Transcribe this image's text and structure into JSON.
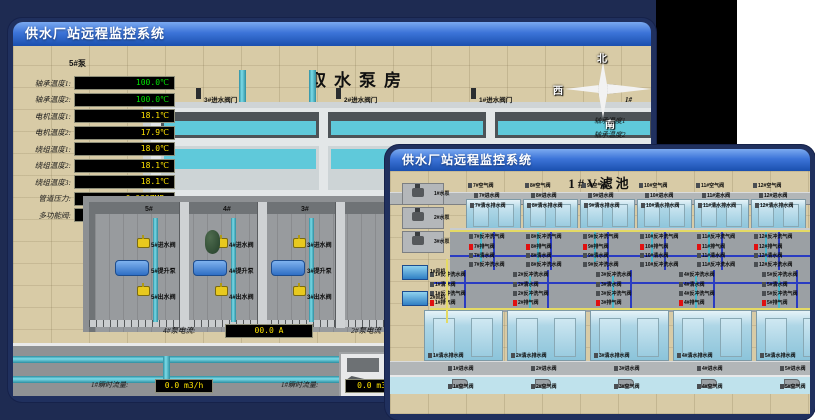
{
  "colors": {
    "backdrop": "#1e2b52",
    "black_panel": "#000000",
    "titlebar_blue": "#1a4fae",
    "value_green": "#00e400",
    "value_yellow": "#ffe400",
    "alarm_red": "#e01010",
    "pipe_cyan": "#5fc9da"
  },
  "back_window": {
    "title": "供水厂站远程监控系统",
    "scene_title": "取水泵房",
    "pump_panel": {
      "header": "5#泵",
      "rows": [
        {
          "label": "轴承温度1:",
          "value": "100.0℃",
          "color": "#00e400"
        },
        {
          "label": "轴承温度2:",
          "value": "100.0℃",
          "color": "#00e400"
        },
        {
          "label": "电机温度1:",
          "value": "18.1℃",
          "color": "#ffe400"
        },
        {
          "label": "电机温度2:",
          "value": "17.9℃",
          "color": "#ffe400"
        },
        {
          "label": "绕组温度1:",
          "value": "18.0℃",
          "color": "#ffe400"
        },
        {
          "label": "绕组温度2:",
          "value": "18.1℃",
          "color": "#ffe400"
        },
        {
          "label": "绕组温度3:",
          "value": "18.1℃",
          "color": "#ffe400"
        },
        {
          "label": "管道压力:",
          "value": "0.0007MPa",
          "color": "#ffe400"
        },
        {
          "label": "多功能阀:",
          "value": "0%",
          "color": "#ffe400"
        }
      ]
    },
    "inlet_valves": [
      "3#进水阀门",
      "2#进水阀门",
      "1#进水阀门"
    ],
    "compass": {
      "north": "北",
      "west": "西",
      "south": "南"
    },
    "right_partial_labels": [
      "1#",
      "轴承温度1",
      "轴承温度2"
    ],
    "pump_bays": [
      {
        "no": "5#",
        "inlet": "5#进水阀",
        "pump": "5#提升泵",
        "outlet": "5#出水阀"
      },
      {
        "no": "4#",
        "inlet": "4#进水阀",
        "pump": "4#提升泵",
        "outlet": "4#出水阀"
      },
      {
        "no": "3#",
        "inlet": "3#进水阀",
        "pump": "3#提升泵",
        "outlet": "3#出水阀"
      }
    ],
    "current_readings": [
      {
        "label": "4#泵电流:",
        "value": "00.0 A"
      },
      {
        "label": "2#泵电流",
        "value": ""
      }
    ],
    "flow_readings": [
      {
        "label": "1#瞬时流量:",
        "value": "0.0 m3/h"
      },
      {
        "label": "1#瞬时流量:",
        "value": "0.0 m3/"
      }
    ]
  },
  "front_window": {
    "title": "供水厂站远程监控系统",
    "scene_title": "1#V滤池",
    "pumps": [
      "1#水泵",
      "2#水泵",
      "3#水泵"
    ],
    "blowers": [
      "1#风机",
      "2#风机"
    ],
    "top_filters": {
      "air": [
        "7#空气阀",
        "8#空气阀",
        "9#空气阀",
        "10#空气阀",
        "11#空气阀",
        "12#空气阀"
      ],
      "inlet": [
        "7#进水阀",
        "8#进水阀",
        "9#进水阀",
        "10#进水阀",
        "11#进水阀",
        "12#进水阀"
      ],
      "drain": [
        "7#清水排水阀",
        "8#清水排水阀",
        "9#清水排水阀",
        "10#清水排水阀",
        "11#清水排水阀",
        "12#清水排水阀"
      ]
    },
    "gallery_top_rows": [
      {
        "red": false,
        "labels": [
          "7#反冲洗气阀",
          "8#反冲洗气阀",
          "9#反冲洗气阀",
          "10#反冲洗气阀",
          "11#反冲洗气阀",
          "12#反冲洗气阀"
        ]
      },
      {
        "red": true,
        "labels": [
          "7#排气阀",
          "8#排气阀",
          "9#排气阀",
          "10#排气阀",
          "11#排气阀",
          "12#排气阀"
        ]
      },
      {
        "red": false,
        "labels": [
          "7#清水阀",
          "8#清水阀",
          "9#清水阀",
          "10#清水阀",
          "11#清水阀",
          "12#清水阀"
        ]
      },
      {
        "red": false,
        "labels": [
          "7#反冲洗水阀",
          "8#反冲洗水阀",
          "9#反冲洗水阀",
          "10#反冲洗水阀",
          "11#反冲洗水阀",
          "12#反冲洗水阀"
        ]
      }
    ],
    "gallery_bottom_rows": [
      {
        "red": false,
        "labels": [
          "1#反冲洗水阀",
          "2#反冲洗水阀",
          "3#反冲洗水阀",
          "4#反冲洗水阀",
          "5#反冲洗水阀",
          "6#反冲洗水阀"
        ]
      },
      {
        "red": false,
        "labels": [
          "1#清水阀",
          "2#清水阀",
          "3#清水阀",
          "4#清水阀",
          "5#清水阀",
          "6#清水阀"
        ]
      },
      {
        "red": false,
        "labels": [
          "1#反冲洗气阀",
          "2#反冲洗气阀",
          "3#反冲洗气阀",
          "4#反冲洗气阀",
          "5#反冲洗气阀",
          "6#反冲洗气阀"
        ]
      },
      {
        "red": true,
        "labels": [
          "1#排气阀",
          "2#排气阀",
          "3#排气阀",
          "4#排气阀",
          "5#排气阀",
          "6#排气阀"
        ]
      }
    ],
    "bottom_filters": {
      "drain": [
        "1#清水排水阀",
        "2#清水排水阀",
        "3#清水排水阀",
        "4#清水排水阀",
        "5#清水排水阀",
        "6#清水排水阀"
      ],
      "inlet": [
        "1#进水阀",
        "2#进水阀",
        "3#进水阀",
        "4#进水阀",
        "5#进水阀",
        "6#进水阀"
      ],
      "air": [
        "1#空气阀",
        "2#空气阀",
        "3#空气阀",
        "4#空气阀",
        "5#空气阀",
        "6#空气阀"
      ]
    }
  }
}
